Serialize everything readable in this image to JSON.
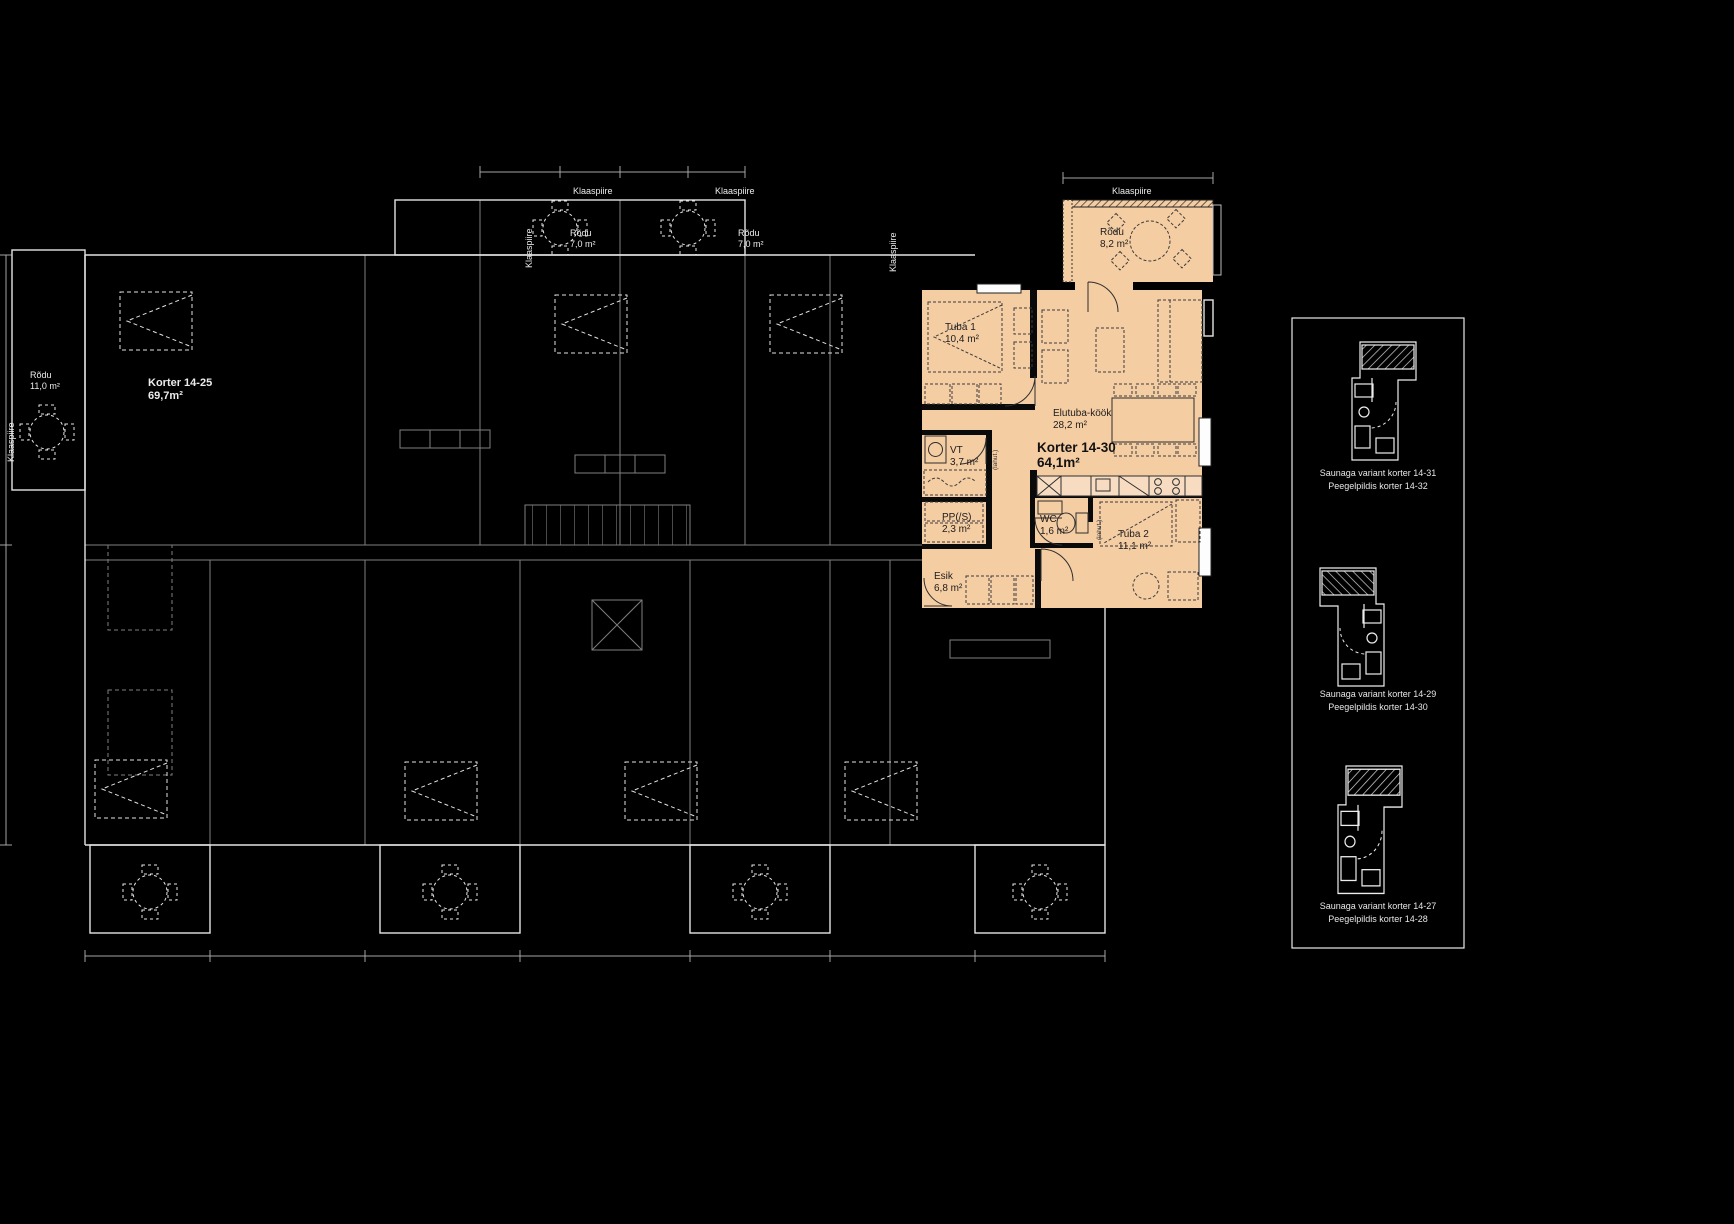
{
  "colors": {
    "background": "#000000",
    "plan_line": "#f0f0f0",
    "highlight_fill": "#f5cda3",
    "highlight_line": "#2e2e2e"
  },
  "highlighted_apartment": {
    "name": "Korter 14-30",
    "area": "64,1m²",
    "rooms": [
      {
        "name": "Rõdu",
        "area": "8,2 m²"
      },
      {
        "name": "Tuba 1",
        "area": "10,4 m²"
      },
      {
        "name": "Elutuba-köök",
        "area": "28,2 m²"
      },
      {
        "name": "VT",
        "area": "3,7 m²"
      },
      {
        "name": "PP(/S)",
        "area": "2,3 m²"
      },
      {
        "name": "WC",
        "area": "1,6 m²"
      },
      {
        "name": "Tuba 2",
        "area": "11,1 m²"
      },
      {
        "name": "Esik",
        "area": "6,8 m²"
      }
    ],
    "partition_label": "(lahut.)"
  },
  "plan": {
    "glass_railing_label": "Klaaspiire",
    "balconies": [
      {
        "name": "Rõdu",
        "area": "7,0 m²"
      },
      {
        "name": "Rõdu",
        "area": "7,0 m²"
      },
      {
        "name": "Rõdu",
        "area": "11,0 m²"
      }
    ],
    "neighbor_apartment": {
      "name": "Korter 14-25",
      "area": "69,7m²"
    }
  },
  "sidebar_variants": [
    {
      "title": "Saunaga variant korter 14-31",
      "subtitle": "Peegelpildis korter 14-32"
    },
    {
      "title": "Saunaga variant korter 14-29",
      "subtitle": "Peegelpildis korter 14-30"
    },
    {
      "title": "Saunaga variant korter 14-27",
      "subtitle": "Peegelpildis korter 14-28"
    }
  ]
}
